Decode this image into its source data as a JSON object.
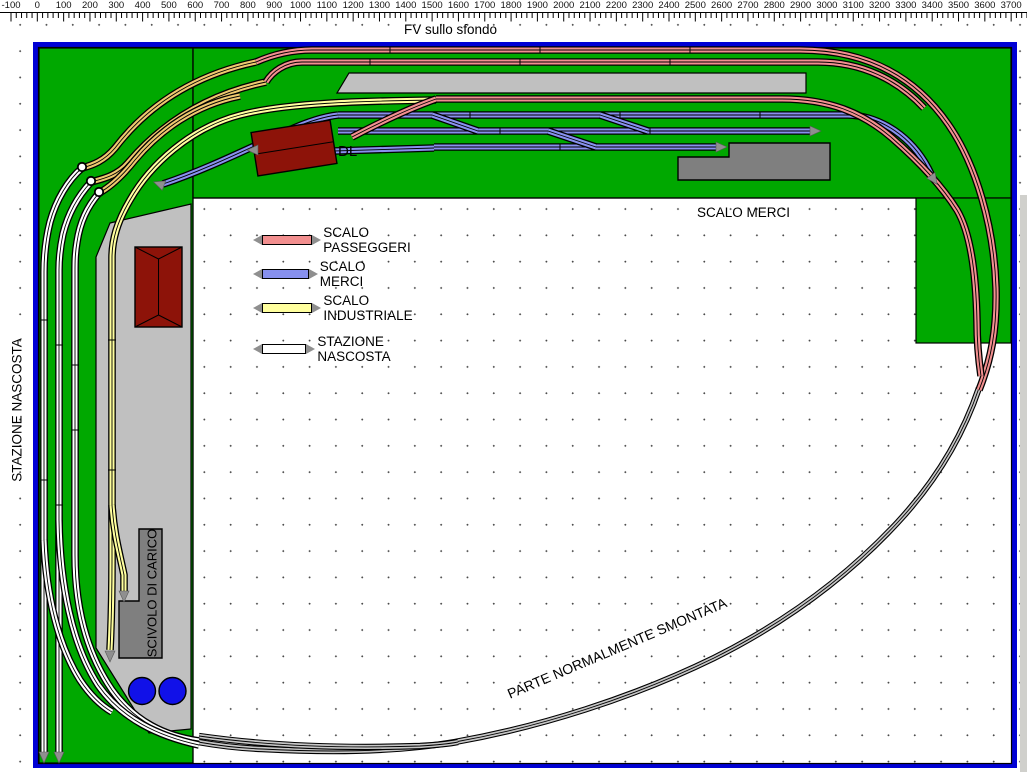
{
  "title": "FV sullo sfondo",
  "ruler": {
    "origin_px": 11,
    "major_px": 26.32,
    "minor_per_major": 5,
    "labels": [
      "-100",
      "0",
      "100",
      "200",
      "300",
      "400",
      "500",
      "600",
      "700",
      "800",
      "900",
      "1000",
      "1100",
      "1200",
      "1300",
      "1400",
      "1500",
      "1600",
      "1700",
      "1800",
      "1900",
      "2000",
      "2100",
      "2200",
      "2300",
      "2400",
      "2500",
      "2600",
      "2700",
      "2800",
      "2900",
      "3000",
      "3100",
      "3200",
      "3300",
      "3400",
      "3500",
      "3600",
      "3700",
      "3800"
    ]
  },
  "labels": {
    "stazione_nascosta": "STAZIONE NASCOSTA",
    "scalo_merci": "SCALO MERCI",
    "dl": "DL",
    "scivolo_di_carico": "SCIVOLO DI CARICO",
    "parte_smontata": "PARTE NORMALMENTE SMONTATA"
  },
  "legend": {
    "items": [
      {
        "label": "SCALO PASSEGGERI",
        "color": "#f28f8f"
      },
      {
        "label": "SCALO MERCI",
        "color": "#8790ee"
      },
      {
        "label": "SCALO INDUSTRIALE",
        "color": "#ffff9e"
      },
      {
        "label": "STAZIONE NASCOSTA",
        "color": "#ffffff"
      }
    ]
  },
  "colors": {
    "green": "#00a800",
    "platform": "#c0c0c0",
    "darkgray": "#7f7f7f",
    "red": "#8d1309",
    "circle": "#1111e8",
    "border": "#0000d4",
    "track_pink": "#f28f8f",
    "track_blue": "#8790ee",
    "track_gold": "#eec86e",
    "track_yellow": "#ffff9e",
    "track_white": "#ffffff",
    "track_gray": "#c6c6c6"
  }
}
